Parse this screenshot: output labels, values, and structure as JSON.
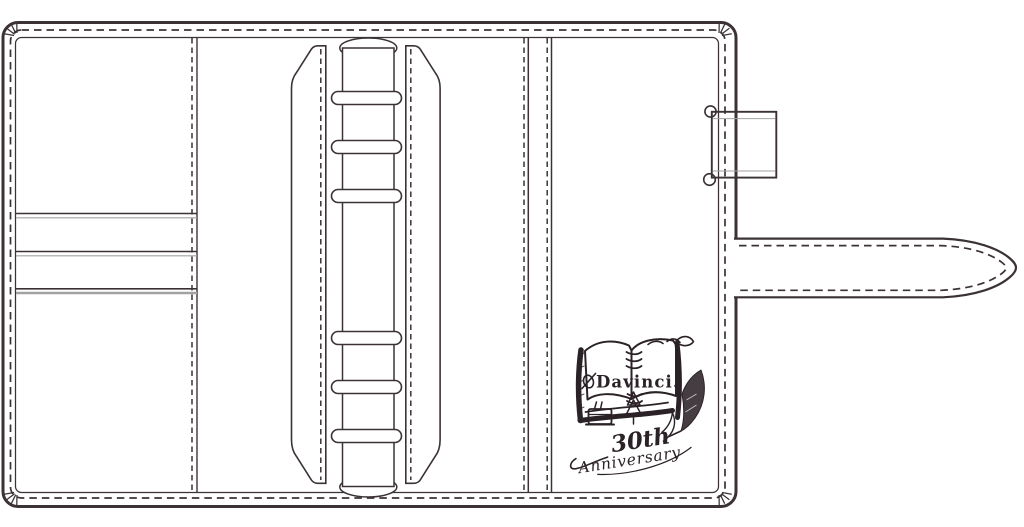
{
  "palette": {
    "background": "#ffffff",
    "line": "#3b3236",
    "shadow": "#a2a2a2",
    "ink": "#2b2227"
  },
  "stamp": {
    "brand": "Davinci.",
    "anniversary_number": "30th",
    "anniversary_word": "Anniversary"
  },
  "binder": {
    "ring_count": 6,
    "card_slot_count": 3,
    "parts": {
      "left_page": "card-pocket-panel",
      "center": "six-ring-spine-with-lifters",
      "right_page": "pen-loop-and-closure-strap"
    }
  }
}
